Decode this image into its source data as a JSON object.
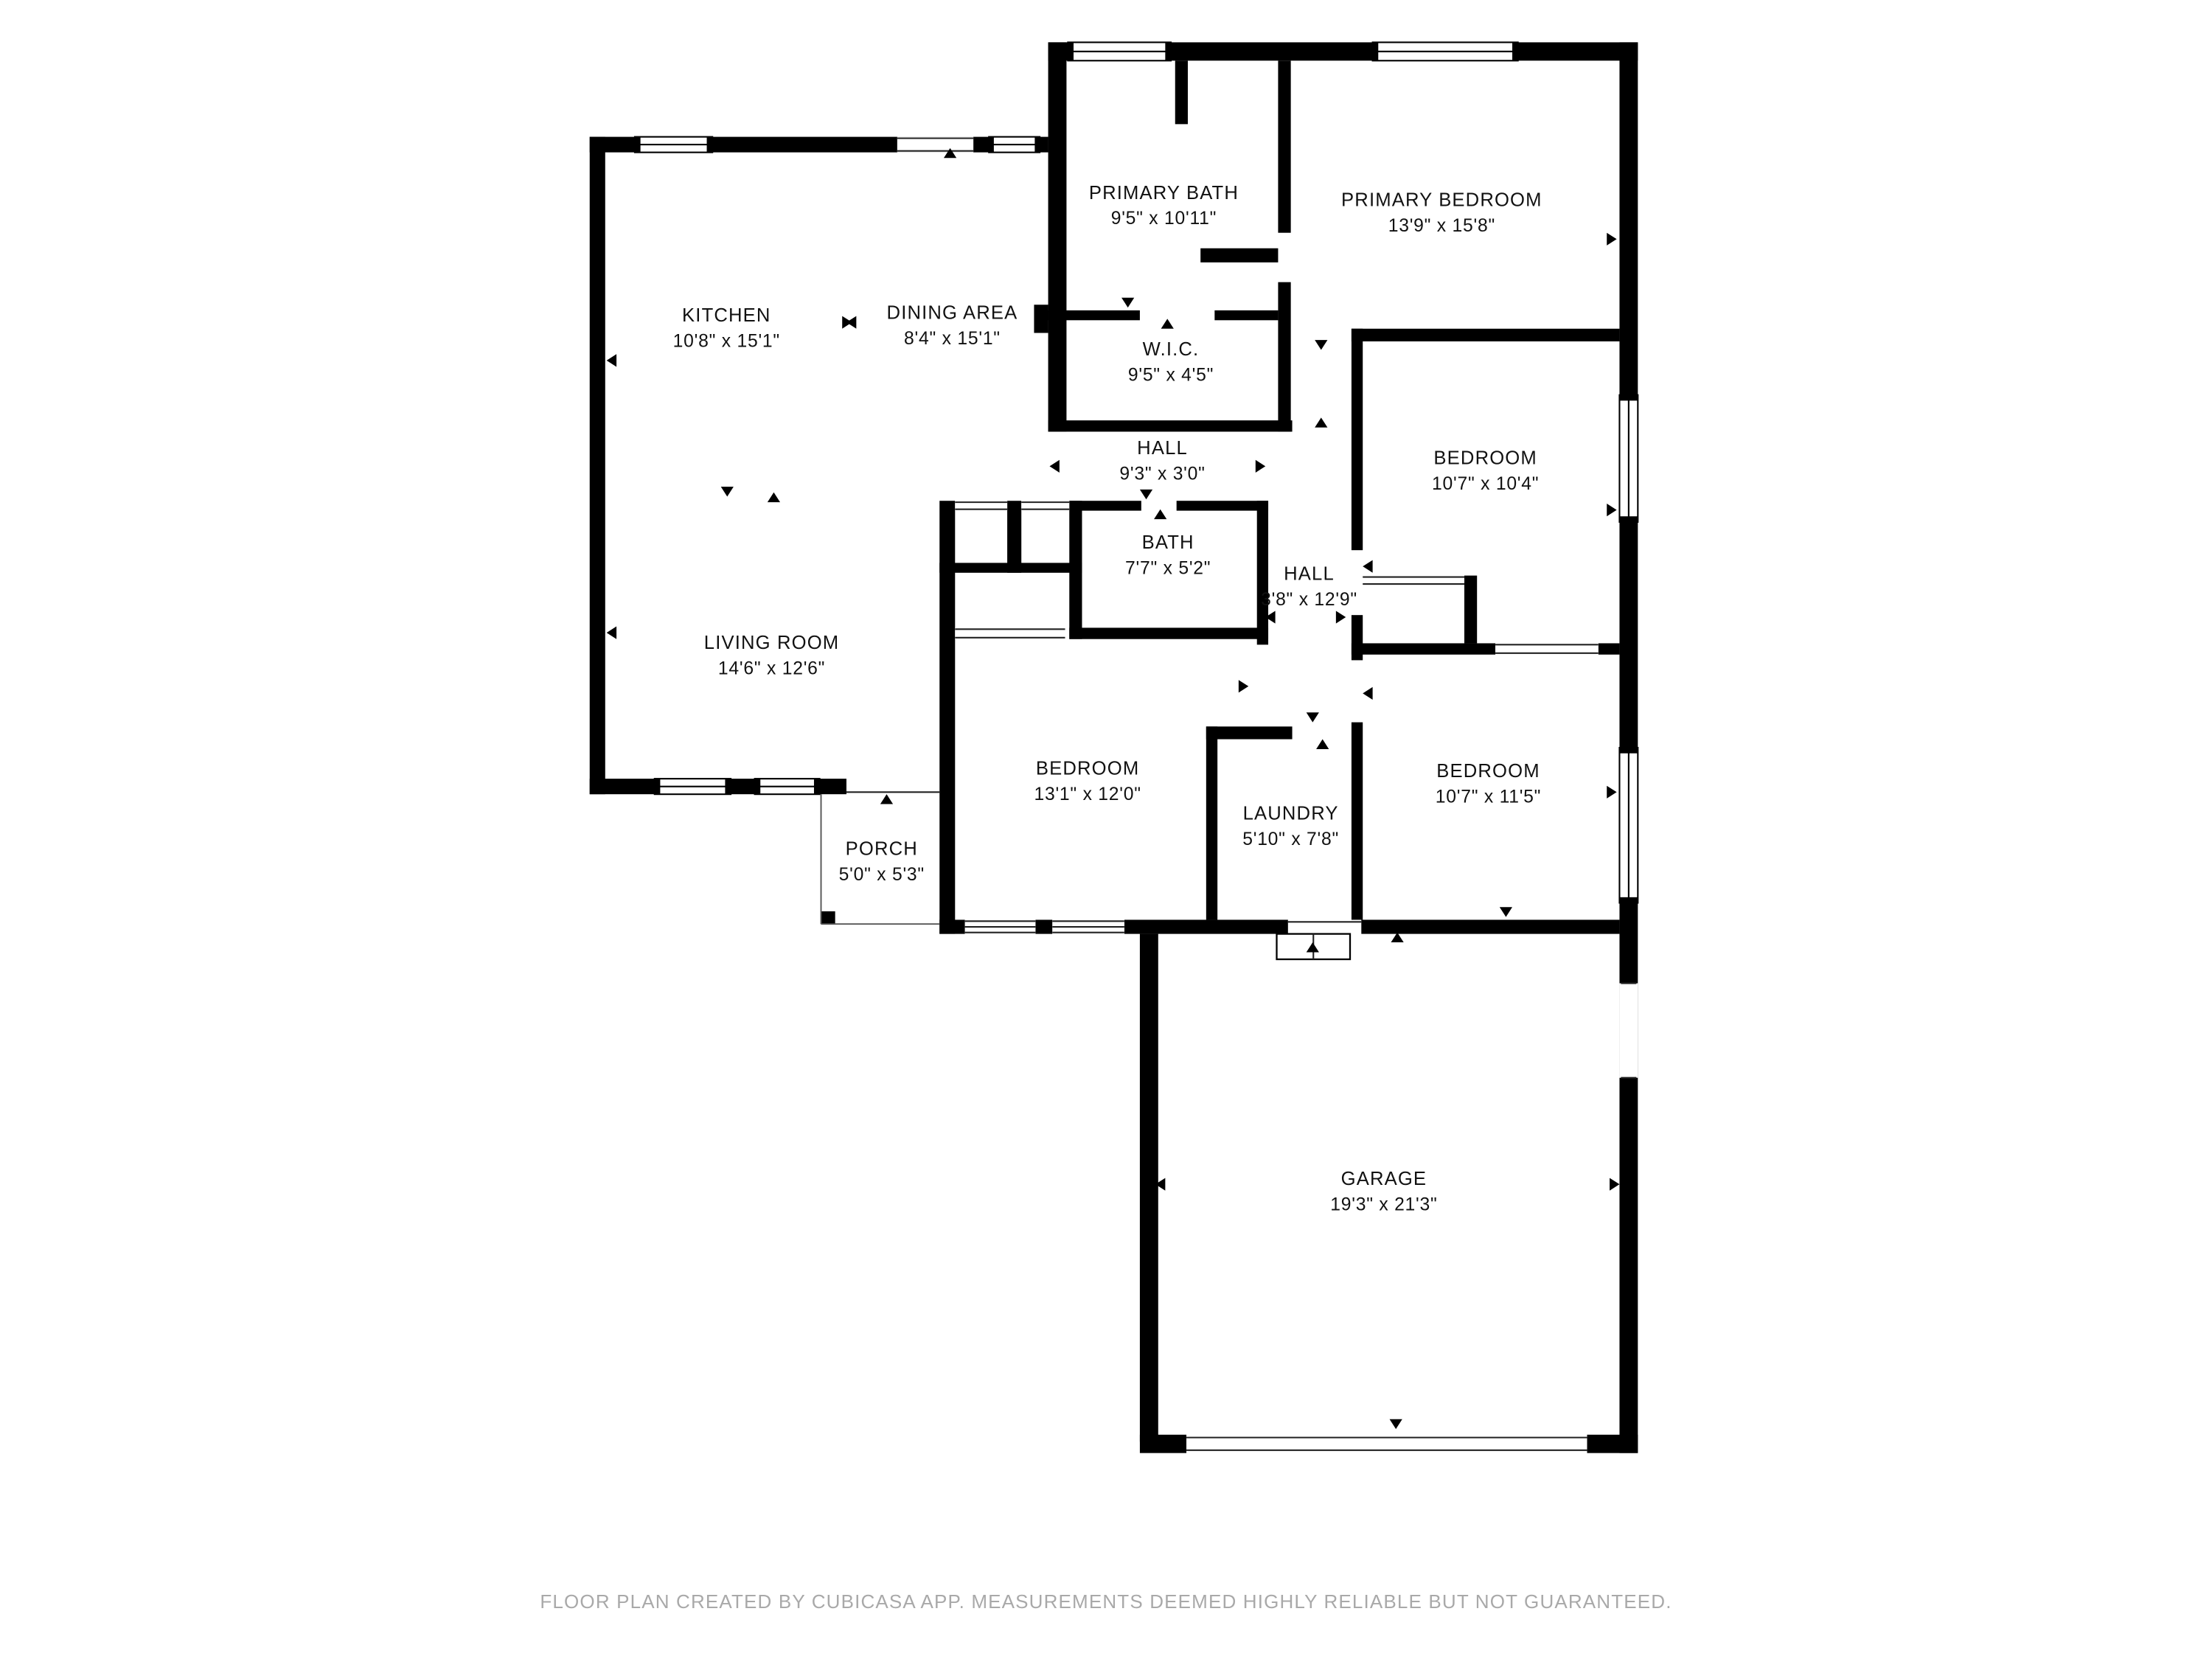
{
  "colors": {
    "wall": "#000000",
    "label": "#111111",
    "footer": "#a9a9a9",
    "background": "#ffffff"
  },
  "rooms": [
    {
      "name": "PRIMARY BATH",
      "dims": "9'5\" x 10'11\""
    },
    {
      "name": "PRIMARY BEDROOM",
      "dims": "13'9\" x 15'8\""
    },
    {
      "name": "KITCHEN",
      "dims": "10'8\" x 15'1\""
    },
    {
      "name": "DINING AREA",
      "dims": "8'4\" x 15'1\""
    },
    {
      "name": "W.I.C.",
      "dims": "9'5\" x 4'5\""
    },
    {
      "name": "HALL",
      "dims": "9'3\" x 3'0\""
    },
    {
      "name": "BEDROOM",
      "dims": "10'7\" x 10'4\""
    },
    {
      "name": "BATH",
      "dims": "7'7\" x 5'2\""
    },
    {
      "name": "HALL",
      "dims": "3'8\" x 12'9\""
    },
    {
      "name": "LIVING ROOM",
      "dims": "14'6\" x 12'6\""
    },
    {
      "name": "BEDROOM",
      "dims": "13'1\" x 12'0\""
    },
    {
      "name": "LAUNDRY",
      "dims": "5'10\" x 7'8\""
    },
    {
      "name": "BEDROOM",
      "dims": "10'7\" x 11'5\""
    },
    {
      "name": "PORCH",
      "dims": "5'0\" x 5'3\""
    },
    {
      "name": "GARAGE",
      "dims": "19'3\" x 21'3\""
    }
  ],
  "footer": "FLOOR PLAN CREATED BY CUBICASA APP. MEASUREMENTS DEEMED HIGHLY RELIABLE BUT NOT GUARANTEED."
}
